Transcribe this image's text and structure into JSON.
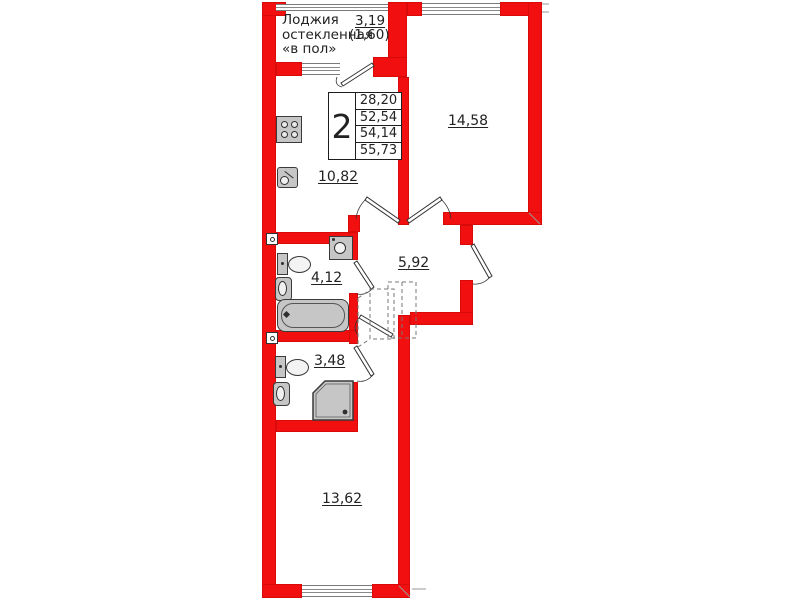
{
  "plan": {
    "type": "apartment floor plan",
    "title_block": {
      "rooms_count": "2",
      "areas": [
        "28,20",
        "52,54",
        "54,14",
        "55,73"
      ]
    },
    "loggia": {
      "label_lines": [
        "Лоджия",
        "остекленная",
        "«в пол»"
      ],
      "area": "3,19",
      "area_secondary": "(1,60)"
    },
    "rooms": [
      {
        "id": "room-top",
        "area": "14,58"
      },
      {
        "id": "kitchen",
        "area": "10,82"
      },
      {
        "id": "hallway",
        "area": "5,92"
      },
      {
        "id": "bathroom",
        "area": "4,12"
      },
      {
        "id": "wc",
        "area": "3,48"
      },
      {
        "id": "room-bottom",
        "area": "13,62"
      }
    ],
    "fixtures": [
      "stove-icon",
      "kitchen-sink-icon",
      "washing-machine-icon",
      "toilet-icon",
      "washbasin-icon",
      "bathtub-icon",
      "shower-cabin-icon",
      "ventilation-icon",
      "door-swing-icon",
      "wardrobe-dashed-icon"
    ],
    "colors": {
      "wall": "#f20f0f",
      "fixture_fill": "#c6c6c6",
      "fixture_stroke": "#3a3a3a",
      "text": "#222222"
    }
  }
}
